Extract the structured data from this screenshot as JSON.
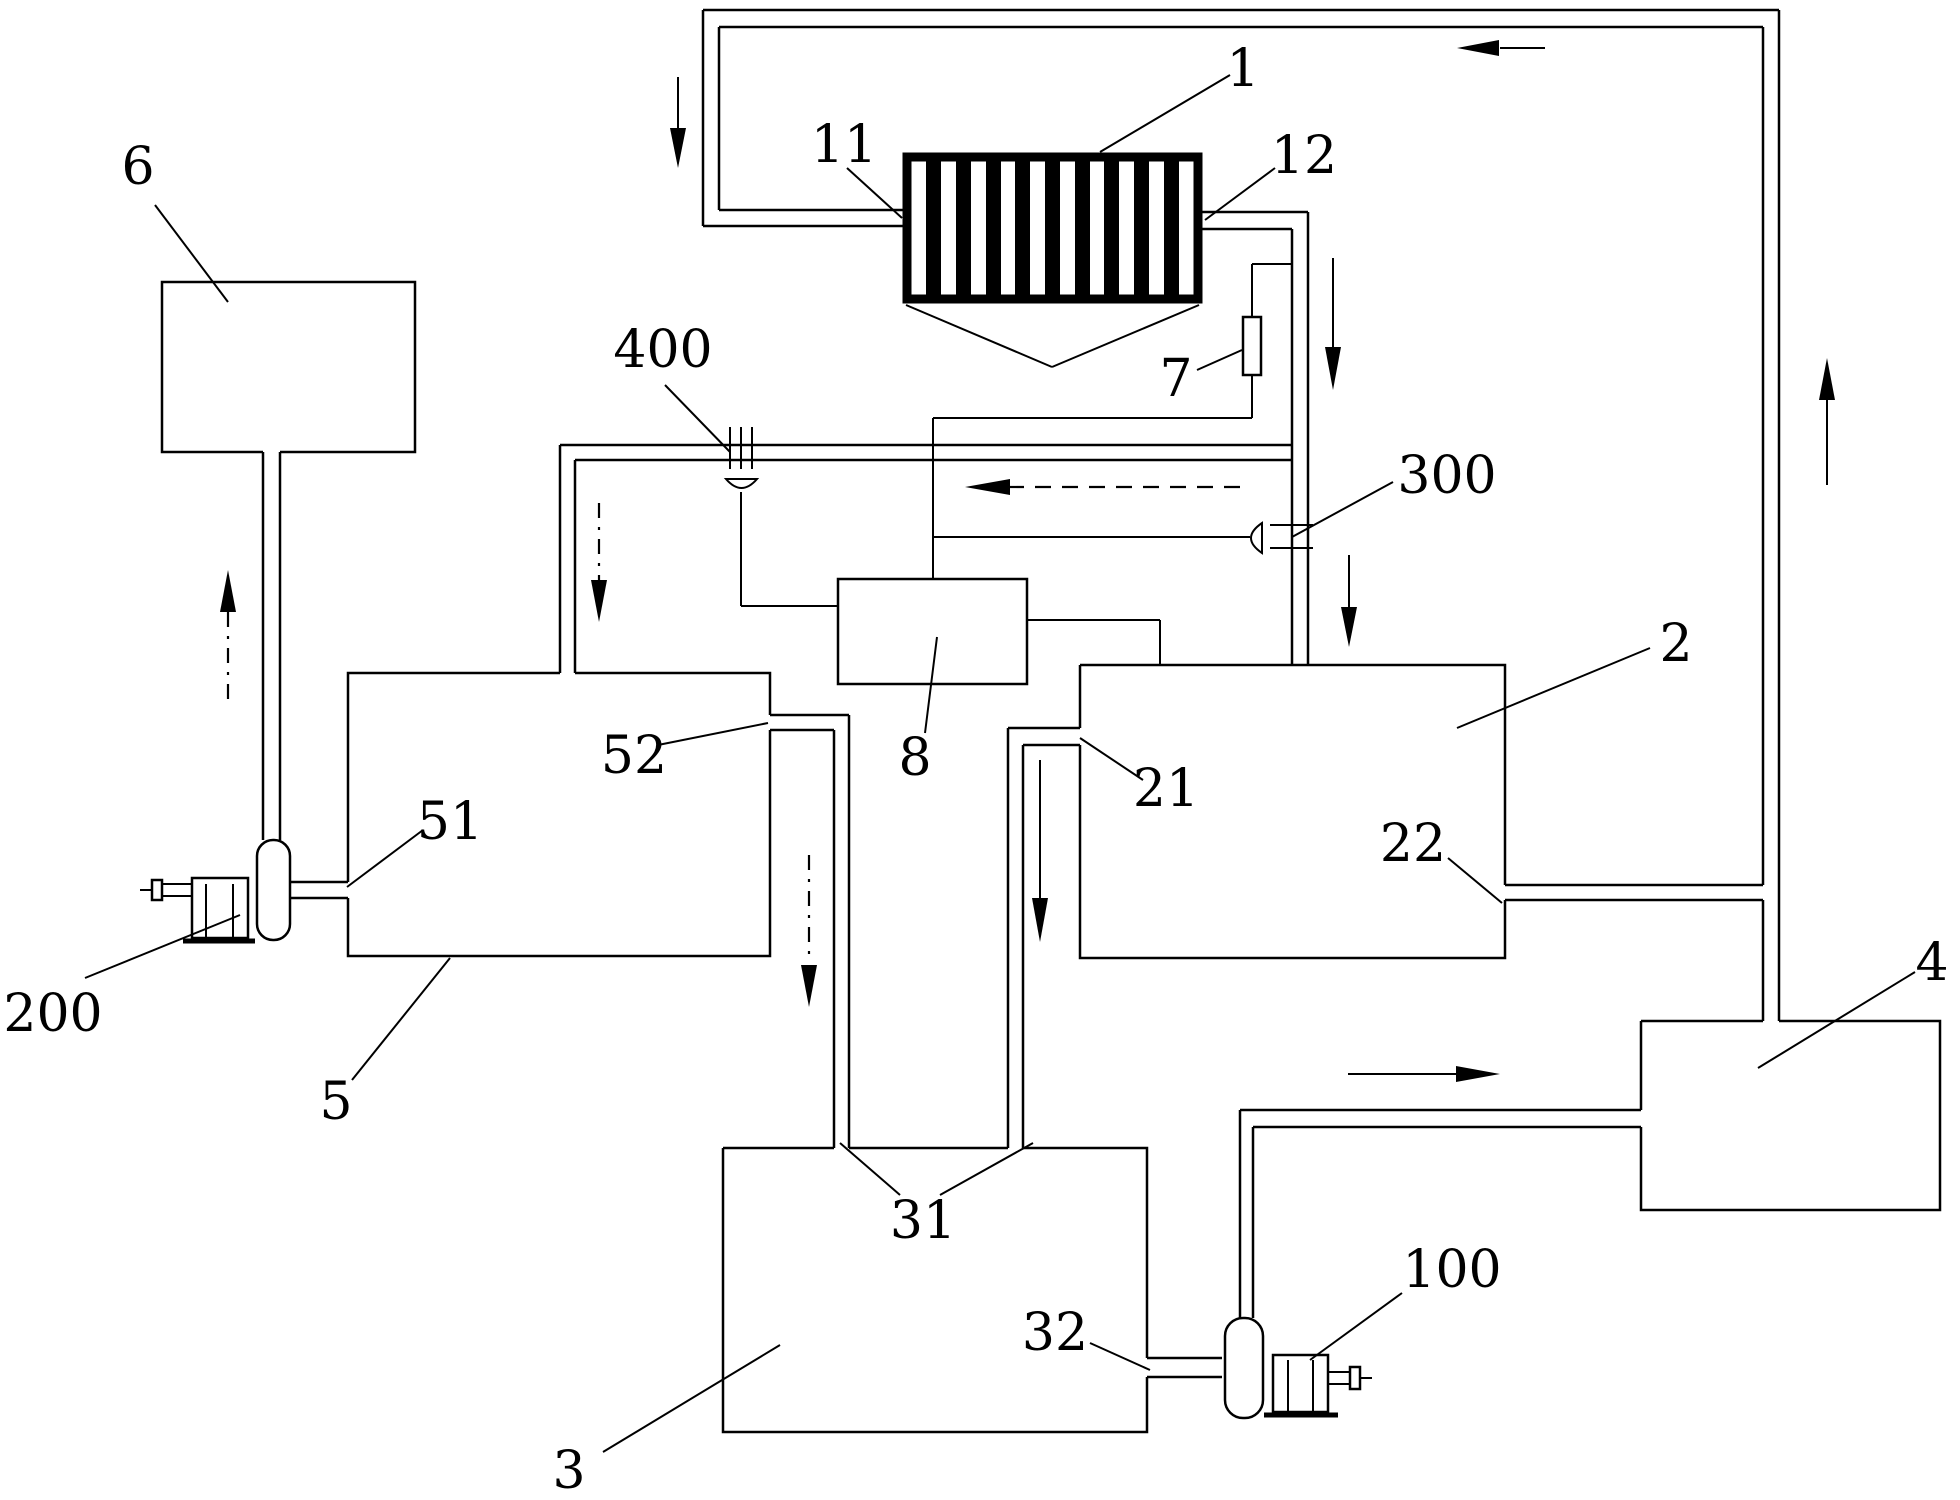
{
  "figure": {
    "background_color": "#ffffff",
    "line_color": "#000000",
    "labels": {
      "n1": "1",
      "n2": "2",
      "n3": "3",
      "n4": "4",
      "n5": "5",
      "n6": "6",
      "n7": "7",
      "n8": "8",
      "n11": "11",
      "n12": "12",
      "n21": "21",
      "n22": "22",
      "n31": "31",
      "n32": "32",
      "n51": "51",
      "n52": "52",
      "n100": "100",
      "n200": "200",
      "n300": "300",
      "n400": "400"
    }
  }
}
